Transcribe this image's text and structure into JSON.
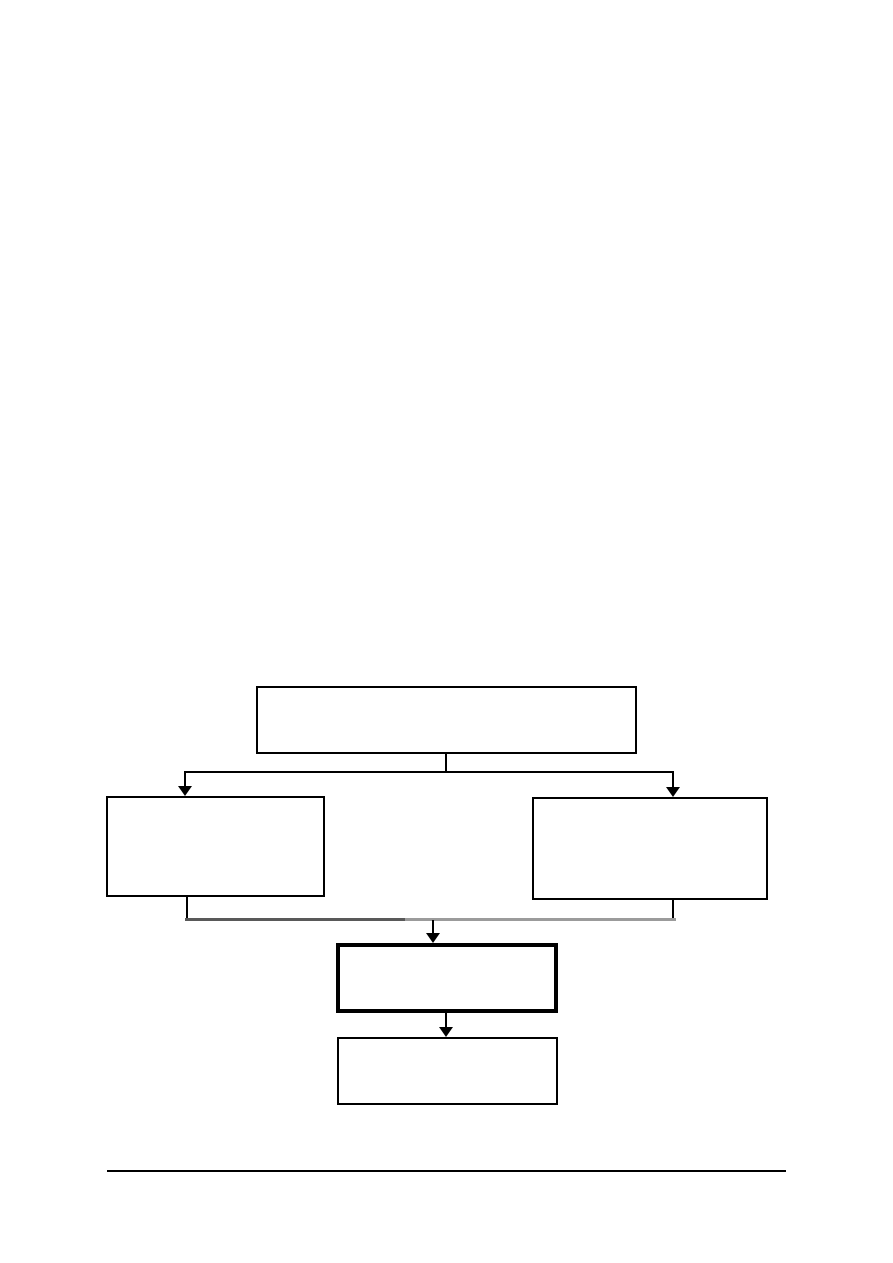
{
  "page": {
    "background": "#ffffff",
    "width": 893,
    "height": 1263
  },
  "diagram": {
    "type": "flowchart",
    "description": "Empty five-box flowchart: top box branches to left and right boxes, which merge into a bold-bordered box, followed by a final box",
    "stroke_color": "#000000",
    "node_fill": "#ffffff",
    "merge_bar_left_color": "#595959",
    "merge_bar_right_color": "#9b9b9b",
    "nodes": [
      {
        "id": "top-box",
        "label": "",
        "x": 256,
        "y": 686,
        "w": 381,
        "h": 68,
        "border_px": 2
      },
      {
        "id": "left-box",
        "label": "",
        "x": 106,
        "y": 796,
        "w": 219,
        "h": 101,
        "border_px": 2
      },
      {
        "id": "right-box",
        "label": "",
        "x": 532,
        "y": 797,
        "w": 236,
        "h": 103,
        "border_px": 2
      },
      {
        "id": "emphasis-box",
        "label": "",
        "x": 336,
        "y": 943,
        "w": 222,
        "h": 70,
        "border_px": 4
      },
      {
        "id": "bottom-box",
        "label": "",
        "x": 337,
        "y": 1037,
        "w": 221,
        "h": 68,
        "border_px": 2
      }
    ],
    "lines": [
      {
        "id": "top-stem",
        "kind": "v",
        "x": 446,
        "y1": 753,
        "y2": 773,
        "thickness": 2,
        "color": "#000000"
      },
      {
        "id": "branch-bar",
        "kind": "h",
        "x1": 184,
        "x2": 674,
        "y": 772,
        "thickness": 2,
        "color": "#000000"
      },
      {
        "id": "left-drop",
        "kind": "v",
        "x": 185,
        "y1": 772,
        "y2": 789,
        "thickness": 2,
        "color": "#000000"
      },
      {
        "id": "right-drop",
        "kind": "v",
        "x": 673,
        "y1": 772,
        "y2": 790,
        "thickness": 2,
        "color": "#000000"
      },
      {
        "id": "left-stub",
        "kind": "v",
        "x": 187,
        "y1": 896,
        "y2": 920,
        "thickness": 2,
        "color": "#000000"
      },
      {
        "id": "right-stub",
        "kind": "v",
        "x": 673,
        "y1": 899,
        "y2": 920,
        "thickness": 2,
        "color": "#000000"
      },
      {
        "id": "merge-bar-left",
        "kind": "h",
        "x1": 185,
        "x2": 405,
        "y": 919,
        "thickness": 3,
        "color": "#595959"
      },
      {
        "id": "merge-bar-right",
        "kind": "h",
        "x1": 405,
        "x2": 676,
        "y": 919,
        "thickness": 3,
        "color": "#9b9b9b"
      },
      {
        "id": "merge-stem",
        "kind": "v",
        "x": 433,
        "y1": 920,
        "y2": 935,
        "thickness": 2,
        "color": "#000000"
      },
      {
        "id": "emphasis-stem",
        "kind": "v",
        "x": 446,
        "y1": 1012,
        "y2": 1029,
        "thickness": 2,
        "color": "#000000"
      }
    ],
    "arrowheads": [
      {
        "id": "left-branch-arrowhead",
        "tip_x": 185,
        "tip_y": 796,
        "width": 14,
        "height": 10,
        "color": "#000000"
      },
      {
        "id": "right-branch-arrowhead",
        "tip_x": 673,
        "tip_y": 797,
        "width": 14,
        "height": 10,
        "color": "#000000"
      },
      {
        "id": "merge-arrowhead",
        "tip_x": 433,
        "tip_y": 943,
        "width": 14,
        "height": 10,
        "color": "#000000"
      },
      {
        "id": "emphasis-arrowhead",
        "tip_x": 446,
        "tip_y": 1037,
        "width": 14,
        "height": 10,
        "color": "#000000"
      }
    ]
  },
  "footer": {
    "rule": {
      "x1": 107,
      "x2": 786,
      "y": 1171,
      "thickness": 2,
      "color": "#000000"
    }
  }
}
